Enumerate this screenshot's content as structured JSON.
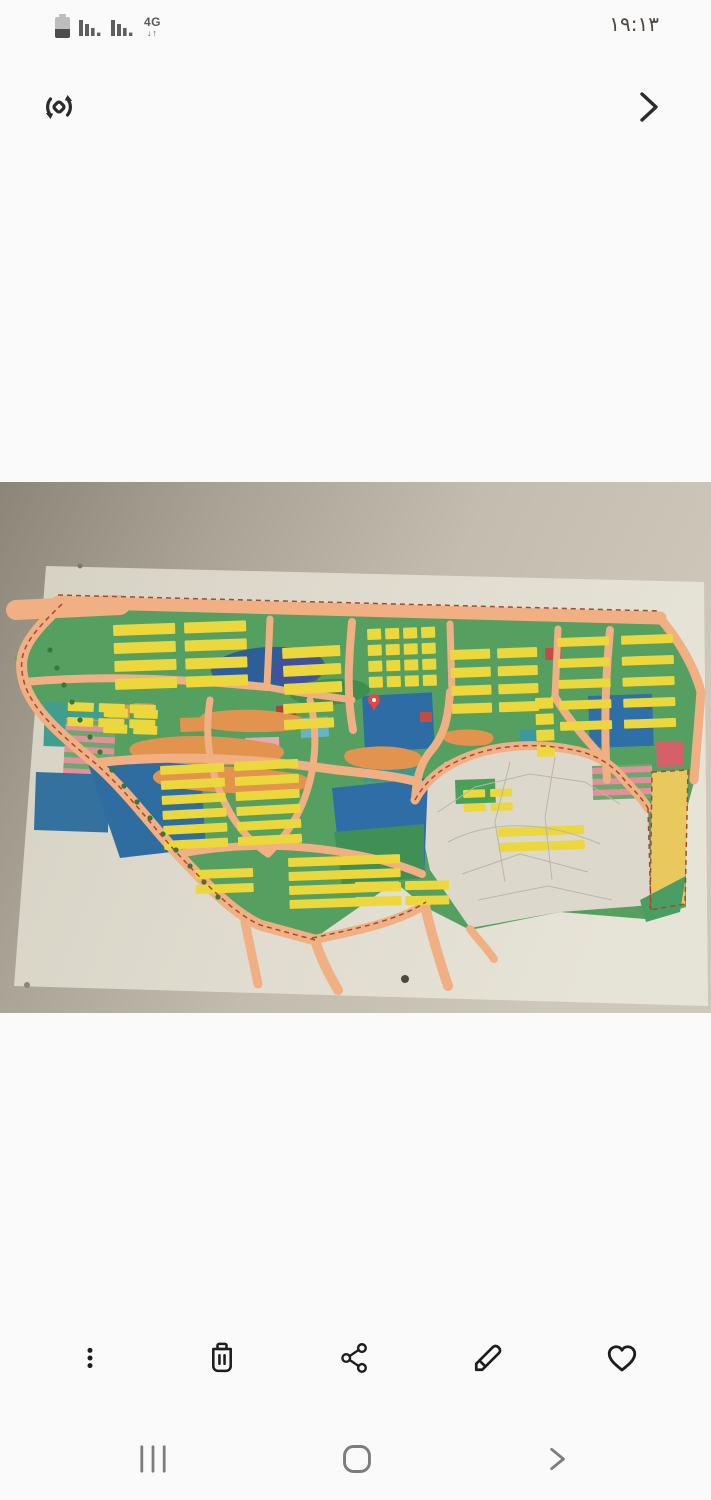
{
  "status_bar": {
    "time": "۱۹:۱۳",
    "network_label": "4G",
    "network_arrows": "↓↑"
  },
  "top_actions": {
    "rotate": "rotate-photo",
    "next": "next-photo"
  },
  "photo": {
    "description": "Photo of a colorful urban master-plan zoning map poster mounted on a wall"
  },
  "toolbar": {
    "items": [
      {
        "name": "more-options"
      },
      {
        "name": "delete"
      },
      {
        "name": "share"
      },
      {
        "name": "edit"
      },
      {
        "name": "favorite"
      }
    ]
  },
  "nav_bar": {
    "items": [
      {
        "name": "recents"
      },
      {
        "name": "home"
      },
      {
        "name": "back"
      }
    ]
  },
  "colors": {
    "bg": "#fafafa",
    "icon_dark": "#1d1d1d",
    "nav_gray": "#7c7c7c",
    "time": "#4b463f",
    "status_gray": "#5f5f5f"
  },
  "map": {
    "palette": {
      "road": "#f0b083",
      "commercial": "#e2944f",
      "block": "#ecd73d",
      "tree": "#2f7a3c",
      "boundary": "#a34a35"
    },
    "base": {
      "points": "60,118 660,134 701,210 694,300 686,330 686,425 645,437 560,430 470,448 425,425 395,400 312,458 255,440 175,370 95,280 30,220 15,176",
      "fill": "#55a061"
    },
    "fan": {
      "points": "415,318 445,280 510,266 575,270 612,286 648,326 652,423 560,430 470,446 430,388",
      "fill": "#dcd8cb",
      "line_color": "#bab6a8",
      "lines": [
        "M438,330 L475,305 L530,292 L585,300 L620,322",
        "M448,360 C490,338 545,338 600,362",
        "M462,392 L520,372 L588,390",
        "M478,418 L548,404 L612,418",
        "M510,280 L495,340 L505,400",
        "M555,275 L545,335 L552,398"
      ]
    },
    "parcels": [
      {
        "type": "ellipse",
        "cx": 268,
        "cy": 186,
        "rx": 57,
        "ry": 21,
        "rot": -3,
        "fill": "#2d5e9a"
      },
      {
        "type": "ellipse",
        "cx": 298,
        "cy": 188,
        "rx": 25,
        "ry": 16,
        "rot": -3,
        "fill": "#474f9c",
        "o": 0.85
      },
      {
        "type": "rect",
        "x": 45,
        "y": 220,
        "w": 66,
        "h": 44,
        "rot": 2,
        "fill": "#3f9e8e"
      },
      {
        "type": "rect",
        "x": 66,
        "y": 236,
        "w": 50,
        "h": 72,
        "rot": 3,
        "fill": "url(#stripes)"
      },
      {
        "type": "rect",
        "x": 36,
        "y": 290,
        "w": 74,
        "h": 58,
        "rot": 2,
        "fill": "#34719f"
      },
      {
        "type": "polygon",
        "points": "88,282 200,274 206,366 120,376",
        "fill": "#2f6da1"
      },
      {
        "type": "rect",
        "x": 362,
        "y": 214,
        "w": 70,
        "h": 56,
        "rot": -3,
        "fill": "#2e6ca6"
      },
      {
        "type": "rect",
        "x": 362,
        "y": 274,
        "w": 54,
        "h": 26,
        "rot": -3,
        "fill": "#3b9796"
      },
      {
        "type": "rect",
        "x": 300,
        "y": 236,
        "w": 28,
        "h": 20,
        "rot": -3,
        "fill": "#64b6c6"
      },
      {
        "type": "polygon",
        "points": "332,306 428,296 424,396 342,402",
        "fill": "#2e6da5"
      },
      {
        "type": "polygon",
        "points": "334,350 424,342 424,396 342,402",
        "fill": "#3f8f56"
      },
      {
        "type": "rect",
        "x": 588,
        "y": 214,
        "w": 64,
        "h": 52,
        "rot": -2,
        "fill": "#2f6fa8"
      },
      {
        "type": "rect",
        "x": 592,
        "y": 284,
        "w": 60,
        "h": 34,
        "rot": -2,
        "fill": "url(#stripes)"
      },
      {
        "type": "rect",
        "x": 656,
        "y": 260,
        "w": 27,
        "h": 25,
        "rot": -2,
        "fill": "#d4606a"
      },
      {
        "type": "polygon",
        "points": "652,290 688,288 685,422 650,428",
        "fill": "#e9c85d"
      },
      {
        "type": "polygon",
        "points": "640,418 686,394 680,430 646,440",
        "fill": "#4b9e63"
      },
      {
        "type": "rect",
        "x": 276,
        "y": 224,
        "w": 20,
        "h": 15,
        "rot": -2,
        "fill": "#a8433c"
      },
      {
        "type": "rect",
        "x": 545,
        "y": 166,
        "w": 16,
        "h": 12,
        "rot": -2,
        "fill": "#c34b44"
      },
      {
        "type": "rect",
        "x": 420,
        "y": 230,
        "w": 12,
        "h": 10,
        "fill": "#c34b44"
      },
      {
        "type": "rect",
        "x": 245,
        "y": 256,
        "w": 34,
        "h": 17,
        "rot": -2,
        "fill": "#e5a9b1"
      },
      {
        "type": "ellipse",
        "cx": 330,
        "cy": 210,
        "rx": 40,
        "ry": 13,
        "rot": -4,
        "fill": "#3e8f4f"
      },
      {
        "type": "rect",
        "x": 455,
        "y": 298,
        "w": 40,
        "h": 24,
        "rot": -2,
        "fill": "#46a258"
      },
      {
        "type": "rect",
        "x": 520,
        "y": 248,
        "w": 22,
        "h": 16,
        "rot": -2,
        "fill": "#3b98a0"
      },
      {
        "type": "rect",
        "x": 108,
        "y": 222,
        "w": 22,
        "h": 14,
        "rot": 2,
        "fill": "#e2944f"
      },
      {
        "type": "rect",
        "x": 134,
        "y": 221,
        "w": 20,
        "h": 14,
        "rot": 2,
        "fill": "#e2944f"
      },
      {
        "type": "rect",
        "x": 180,
        "y": 236,
        "w": 26,
        "h": 14,
        "rot": -2,
        "fill": "#e2944f"
      }
    ],
    "blobs": [
      "M138,260 C180,250 230,254 270,261 C288,264 290,276 268,280 C220,286 168,282 142,277 C126,273 126,264 138,260 Z",
      "M160,288 C205,281 255,285 298,292 C314,295 312,307 294,309 C248,314 198,310 165,304 C150,300 150,292 160,288 Z",
      "M206,231 C242,225 276,228 298,234 C308,237 306,246 294,248 C258,252 222,250 205,245 C197,242 198,233 206,231 Z",
      "M350,268 C378,262 400,264 416,270 C425,274 422,284 410,286 C384,290 360,287 349,281 C342,277 343,270 350,268 Z",
      "M446,250 C462,246 478,247 490,251 C496,254 494,262 484,263 C466,265 450,263 444,258 C441,255 442,251 446,250 Z"
    ],
    "roads": [
      {
        "d": "M16,128 L120,123",
        "w": 20
      },
      {
        "d": "M58,120 L660,136",
        "w": 13
      },
      {
        "d": "M62,122 C28,155 16,170 24,200 C32,228 60,252 95,281 C128,310 150,342 178,372 C206,402 232,430 260,443 L315,458",
        "w": 11
      },
      {
        "d": "M312,458 C360,448 398,440 426,422",
        "w": 9
      },
      {
        "d": "M270,137 L267,205",
        "w": 7
      },
      {
        "d": "M352,140 C349,175 346,210 353,248",
        "w": 8
      },
      {
        "d": "M450,142 L452,210",
        "w": 7
      },
      {
        "d": "M558,147 L555,215",
        "w": 7
      },
      {
        "d": "M610,148 C605,200 604,250 607,298",
        "w": 8
      },
      {
        "d": "M24,200 C110,192 190,198 267,205",
        "w": 8
      },
      {
        "d": "M95,281 C170,272 250,276 330,287 C360,291 392,293 418,300",
        "w": 9
      },
      {
        "d": "M178,372 C240,360 300,362 352,372 C380,377 400,383 422,392",
        "w": 8
      },
      {
        "d": "M267,205 C300,212 330,214 352,218",
        "w": 7
      },
      {
        "d": "M210,218 C205,250 208,280 220,310 C232,340 248,358 268,372",
        "w": 7
      },
      {
        "d": "M310,218 C318,250 316,285 305,315 C298,335 285,355 268,372",
        "w": 7
      },
      {
        "d": "M555,215 C570,240 590,262 612,286",
        "w": 8
      },
      {
        "d": "M450,210 C448,238 444,254 430,270 C420,282 416,298 415,318",
        "w": 8
      },
      {
        "d": "M415,318 C428,294 450,280 478,271 C512,261 548,262 578,269 C600,274 616,286 626,300 C636,310 643,318 648,326",
        "w": 9
      },
      {
        "d": "M245,440 L258,502",
        "w": 9
      },
      {
        "d": "M315,458 C322,480 330,494 338,508",
        "w": 10
      },
      {
        "d": "M425,424 C432,455 440,480 448,504",
        "w": 10
      },
      {
        "d": "M470,447 C480,460 488,468 494,477",
        "w": 8
      },
      {
        "d": "M660,136 C680,160 694,184 701,210 L694,298",
        "w": 9
      }
    ],
    "clusters": [
      {
        "x": 113,
        "y": 143,
        "rot": -2,
        "rows": 4,
        "cols": 2,
        "bw": 62,
        "bh": 11,
        "gx": 9,
        "gy": 7
      },
      {
        "x": 68,
        "y": 220,
        "rot": 2,
        "rows": 2,
        "cols": 3,
        "bw": 26,
        "bh": 9,
        "gx": 5,
        "gy": 6
      },
      {
        "x": 282,
        "y": 166,
        "rot": -3,
        "rows": 3,
        "cols": 1,
        "bw": 58,
        "bh": 11,
        "gx": 0,
        "gy": 7
      },
      {
        "x": 283,
        "y": 222,
        "rot": -3,
        "rows": 2,
        "cols": 1,
        "bw": 50,
        "bh": 10,
        "gx": 0,
        "gy": 6
      },
      {
        "x": 367,
        "y": 147,
        "rot": -2,
        "rows": 4,
        "cols": 4,
        "bw": 14,
        "bh": 11,
        "gx": 4,
        "gy": 5
      },
      {
        "x": 450,
        "y": 168,
        "rot": -2,
        "rows": 4,
        "cols": 2,
        "bw": 40,
        "bh": 10,
        "gx": 7,
        "gy": 8
      },
      {
        "x": 557,
        "y": 156,
        "rot": -2,
        "rows": 5,
        "cols": 2,
        "bw": 52,
        "bh": 9,
        "gx": 12,
        "gy": 12
      },
      {
        "x": 104,
        "y": 226,
        "rot": 2,
        "rows": 2,
        "cols": 2,
        "bw": 24,
        "bh": 9,
        "gx": 6,
        "gy": 7
      },
      {
        "x": 160,
        "y": 284,
        "rot": -3,
        "rows": 6,
        "cols": 2,
        "bw": 64,
        "bh": 9,
        "gx": 10,
        "gy": 6
      },
      {
        "x": 288,
        "y": 376,
        "rot": -2,
        "rows": 4,
        "cols": 1,
        "bw": 112,
        "bh": 9,
        "gx": 0,
        "gy": 5
      },
      {
        "x": 195,
        "y": 388,
        "rot": -2,
        "rows": 2,
        "cols": 1,
        "bw": 58,
        "bh": 9,
        "gx": 0,
        "gy": 6
      },
      {
        "x": 355,
        "y": 400,
        "rot": -1,
        "rows": 2,
        "cols": 2,
        "bw": 44,
        "bh": 9,
        "gx": 6,
        "gy": 6
      },
      {
        "x": 498,
        "y": 346,
        "rot": -2,
        "rows": 2,
        "cols": 1,
        "bw": 86,
        "bh": 9,
        "gx": 0,
        "gy": 6
      },
      {
        "x": 535,
        "y": 216,
        "rot": -2,
        "rows": 4,
        "cols": 1,
        "bw": 18,
        "bh": 11,
        "gx": 0,
        "gy": 5
      },
      {
        "x": 463,
        "y": 308,
        "rot": -2,
        "rows": 2,
        "cols": 2,
        "bw": 22,
        "bh": 8,
        "gx": 5,
        "gy": 6
      }
    ],
    "trees": [
      [
        50,
        168
      ],
      [
        57,
        186
      ],
      [
        64,
        203
      ],
      [
        72,
        220
      ],
      [
        80,
        238
      ],
      [
        90,
        255
      ],
      [
        100,
        270
      ],
      [
        112,
        288
      ],
      [
        124,
        304
      ],
      [
        137,
        320
      ],
      [
        150,
        336
      ],
      [
        163,
        352
      ],
      [
        176,
        368
      ],
      [
        190,
        384
      ],
      [
        204,
        400
      ],
      [
        218,
        415
      ]
    ],
    "dashed": [
      "M58,113 L660,129",
      "M62,122 C28,155 16,170 24,200 C32,228 60,252 95,281 C128,310 150,342 178,372 C206,402 232,430 260,443 L315,458",
      "M415,318 C428,294 450,280 478,271 C512,261 548,262 578,269 C600,274 616,286 626,300 C636,310 643,318 648,326",
      "M652,290 L688,288 L685,422 L650,428 Z",
      "M312,456 C360,446 398,438 426,420",
      "M648,326 L651,428"
    ],
    "pin": {
      "x": 374,
      "y": 218,
      "color": "#e8463c"
    },
    "screws": [
      {
        "x": 80,
        "y": 84,
        "r": 2.5,
        "fill": "#7d7868"
      },
      {
        "x": 27,
        "y": 503,
        "r": 3,
        "fill": "#8a8577"
      },
      {
        "x": 405,
        "y": 497,
        "r": 4,
        "fill": "#50483c"
      }
    ]
  }
}
